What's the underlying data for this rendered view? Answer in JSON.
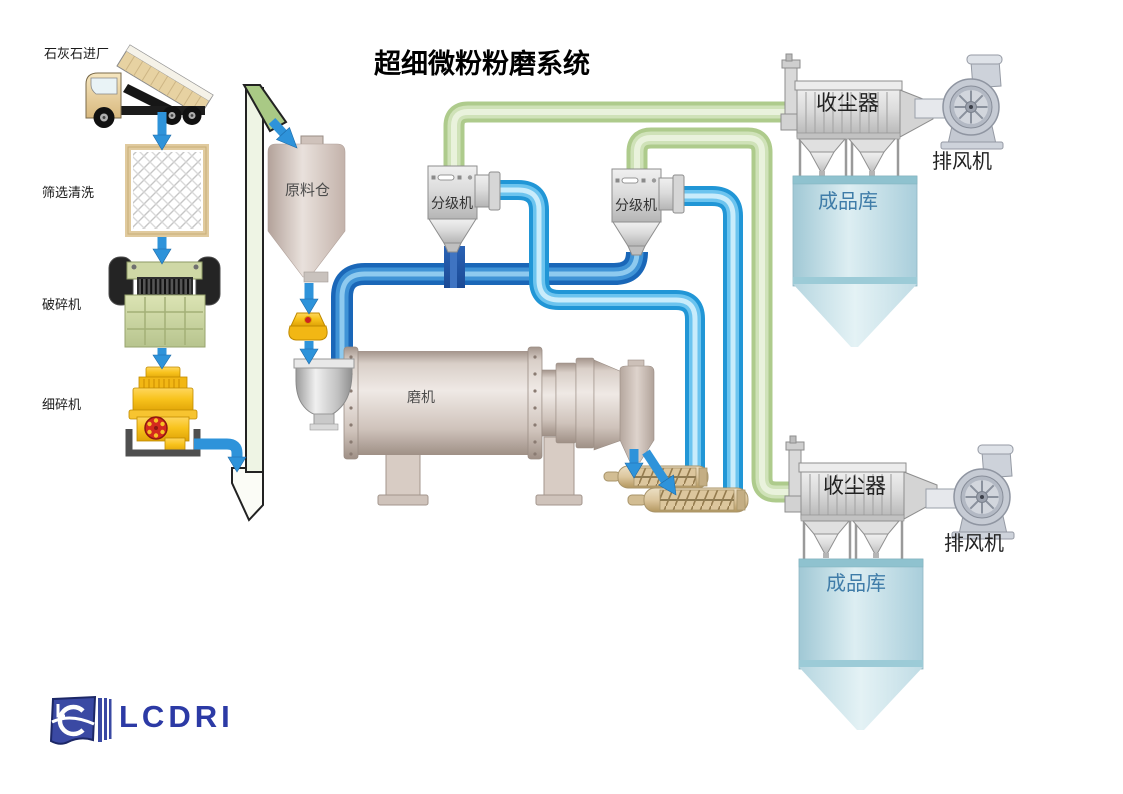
{
  "title": "超细微粉粉磨系统",
  "logo": {
    "text": "LCDRI"
  },
  "labels": {
    "limestone_entry": "石灰石进厂",
    "screening": "筛选清洗",
    "crusher": "破碎机",
    "fine_crusher": "细碎机",
    "raw_material_silo": "原料仓",
    "classifier_1": "分级机",
    "classifier_2": "分级机",
    "mill": "磨机",
    "dust_collector_top": "收尘器",
    "dust_collector_bottom": "收尘器",
    "exhaust_fan_top": "排风机",
    "exhaust_fan_bottom": "排风机",
    "product_silo_top": "成品库",
    "product_silo_bottom": "成品库"
  },
  "colors": {
    "air_pipe_green": "#aecb8c",
    "material_pipe_cyan": "#2196d6",
    "material_pipe_royal": "#1a67b8",
    "pipe_connector_dark": "#1e4f9e",
    "arrow_blue": "#2e93da",
    "raw_silo_tan": "#cdbcb4",
    "crusher_green": "#c8d29c",
    "fine_crusher_yellow": "#f6c224",
    "equipment_gray": "#d9d9d9",
    "product_silo_blue": "#bfdde8",
    "product_silo_text": "#3f7ca8",
    "logo_blue": "#2c3aa5"
  }
}
